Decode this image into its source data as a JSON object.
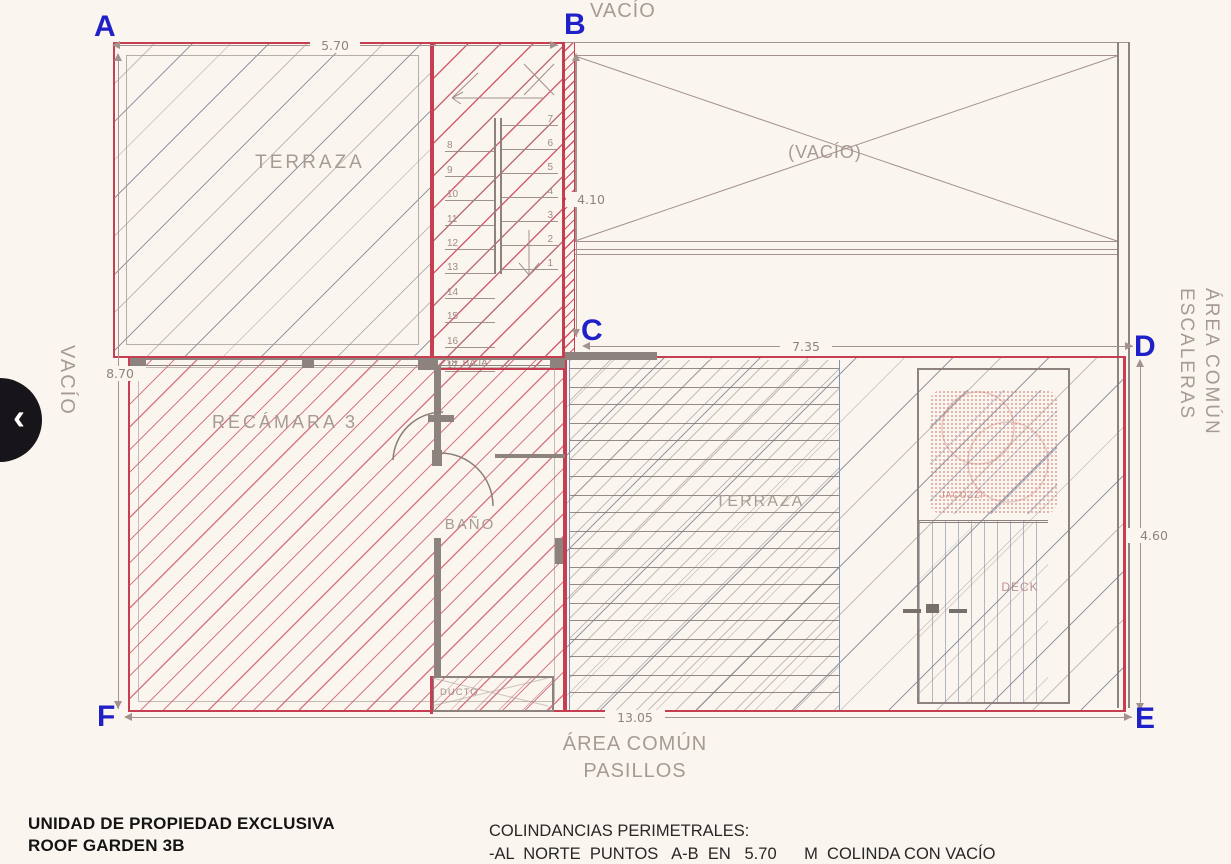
{
  "corners": {
    "a": "A",
    "b": "B",
    "c": "C",
    "d": "D",
    "e": "E",
    "f": "F"
  },
  "dimensions": {
    "top": "5.70",
    "left": "8.70",
    "stairwell": "4.10",
    "middle": "7.35",
    "right": "4.60",
    "bottom": "13.05"
  },
  "rooms": {
    "terraza_upper": "TERRAZA",
    "vacio_inner": "(VACÍO)",
    "recamara": "RECÁMARA 3",
    "bano": "BAÑO",
    "terraza_center": "TERRAZA",
    "deck": "DECK",
    "ducto": "DUCTO",
    "jacuzzi": "JACUZZI"
  },
  "stairs": {
    "left_numbers": [
      "8",
      "9",
      "10",
      "11",
      "12",
      "13",
      "14",
      "15",
      "16",
      "17"
    ],
    "right_numbers": [
      "7",
      "6",
      "5",
      "4",
      "3",
      "2",
      "1"
    ],
    "bottom_label": "18  BAJA"
  },
  "surroundings": {
    "vacio_top": "VACÍO",
    "vacio_left": "VACÍO",
    "area_comun_right_line1": "ÁREA COMÚN",
    "area_comun_right_line2": "ESCALERAS",
    "area_comun_bottom_line1": "ÁREA COMÚN",
    "area_comun_bottom_line2": "PASILLOS"
  },
  "footer": {
    "unit_title_line1": "UNIDAD DE PROPIEDAD EXCLUSIVA",
    "unit_title_line2": "ROOF GARDEN 3B",
    "colindancias_title": "COLINDANCIAS PERIMETRALES:",
    "colindancias_item1": "-AL  NORTE  PUNTOS   A-B  EN   5.70      M  COLINDA CON VACÍO"
  },
  "nav": {
    "prev_label": "‹"
  },
  "colors": {
    "red": "#c53f51",
    "blue": "#2020c8",
    "line_gray": "#a3928d",
    "wall_gray": "#8d827e",
    "background": "#faf5ee"
  }
}
